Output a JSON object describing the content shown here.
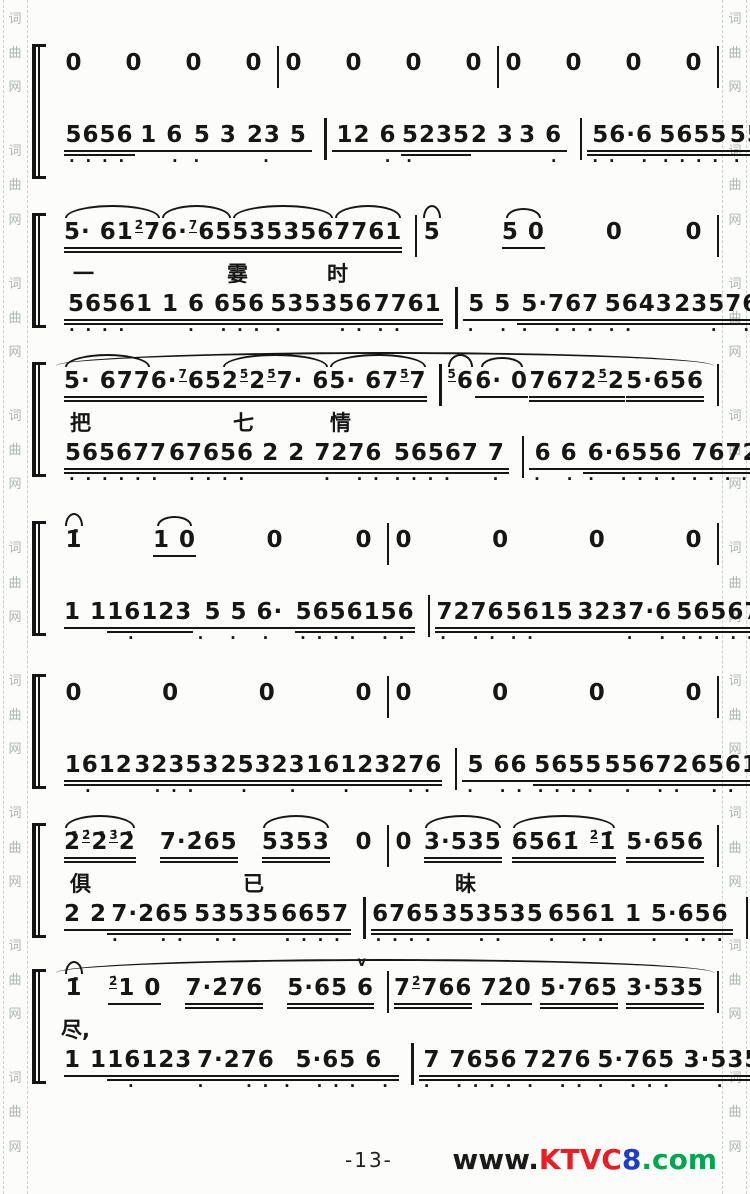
{
  "colors": {
    "ink": "#161616",
    "paper": "#fcfcfa",
    "border_char": "#aeb6ae",
    "watermark_www": "#1a1a1a",
    "watermark_ktvc": "#ec1c24",
    "watermark_eight": "#1f3ccc",
    "watermark_com": "#00a650"
  },
  "border": {
    "chars": [
      "词",
      "曲",
      "网"
    ],
    "repeats": 9
  },
  "footer": {
    "page_number": "-13-",
    "watermark": {
      "www": "www.",
      "ktvc": "KTVC",
      "eight": "8",
      "com": ".com"
    }
  },
  "systems": [
    {
      "melody": [
        [
          {
            "t": "0"
          },
          {
            "t": "0"
          },
          {
            "t": "0"
          },
          {
            "t": "0"
          }
        ],
        [
          {
            "t": "0"
          },
          {
            "t": "0"
          },
          {
            "t": "0"
          },
          {
            "t": "0"
          }
        ],
        [
          {
            "t": "0"
          },
          {
            "t": "0"
          },
          {
            "t": "0"
          },
          {
            "t": "0"
          }
        ]
      ],
      "lyrics": [],
      "accomp": [
        [
          {
            "t": "5656",
            "u": 2,
            "db": "...."
          },
          {
            "t": "1 6",
            "u": 1,
            "db": "  ."
          },
          {
            "t": "5 3",
            "u": 1,
            "db": ".  "
          },
          {
            "t": "23 5",
            "u": 1,
            "db": " .  "
          }
        ],
        [
          {
            "t": "12 6",
            "u": 1,
            "db": "   ."
          },
          {
            "t": "5235",
            "u": 2,
            "db": ".   "
          },
          {
            "t": "2 3",
            "u": 1
          },
          {
            "t": "3 6",
            "u": 1,
            "db": "  ."
          }
        ],
        [
          {
            "t": "56·6",
            "u": 2,
            "db": ".. ."
          },
          {
            "t": "5655",
            "u": 2,
            "db": "...."
          },
          {
            "t": "55672",
            "u": 2,
            "db": ". ...",
            "ann": "(内)"
          },
          {
            "t": "65612",
            "u": 2,
            "db": ".  ..",
            "ann": "(内)"
          }
        ]
      ]
    },
    {
      "melody": [
        [
          {
            "t": "5· 61{2̇}7",
            "u": 2,
            "arc": true
          },
          {
            "t": "6·{7}65",
            "u": 2,
            "arc": true
          },
          {
            "t": "535356",
            "u": 2,
            "arc": true
          },
          {
            "t": "7761",
            "u": 2,
            "arc": true
          }
        ],
        [
          {
            "t": "5",
            "arc": true
          },
          {
            "t": "5 0",
            "u": 1,
            "tie": true
          },
          {
            "t": "0"
          },
          {
            "t": "0"
          }
        ]
      ],
      "lyrics": [
        {
          "x": 15,
          "t": "一"
        },
        {
          "x": 169,
          "t": "霎"
        },
        {
          "x": 269,
          "t": "时"
        }
      ],
      "accomp": [
        [
          {
            "t": "56561 1",
            "u": 2,
            "db": "....   "
          },
          {
            "t": "6 656",
            "u": 2,
            "db": ". ..."
          },
          {
            "t": "535356",
            "u": 2,
            "db": ".   .."
          },
          {
            "t": "7761",
            "u": 2,
            "db": "..  "
          }
        ],
        [
          {
            "t": "5 5",
            "u": 1,
            "db": ". ."
          },
          {
            "t": "5·767",
            "u": 2,
            "db": ". ..."
          },
          {
            "t": "5643",
            "u": 2,
            "db": "..  "
          },
          {
            "t": "23576",
            "u": 2,
            "db": "  . ."
          }
        ]
      ]
    },
    {
      "topline": true,
      "melody": [
        [
          {
            "t": "5· 677",
            "u": 2,
            "arc": true
          },
          {
            "t": "6·{7}65",
            "u": 2
          },
          {
            "t": "2{5̇}2{5̇}7· 6",
            "u": 2,
            "arc": true
          },
          {
            "t": "5· 67{5̇}7",
            "u": 2,
            "arc": true
          }
        ],
        [
          {
            "t": "{5̇}6",
            "arc": true
          },
          {
            "t": "6· 0",
            "u": 1,
            "tie": true
          },
          {
            "t": "7672{5̇}2",
            "u": 2
          },
          {
            "t": "5·656",
            "u": 2
          }
        ]
      ],
      "lyrics": [
        {
          "x": 12,
          "t": "把"
        },
        {
          "x": 175,
          "t": "七"
        },
        {
          "x": 272,
          "t": "情"
        }
      ],
      "accomp": [
        [
          {
            "t": "565677",
            "u": 2,
            "db": "......"
          },
          {
            "t": "67656",
            "u": 2,
            "db": " ...."
          },
          {
            "t": "2 2 7276",
            "u": 2,
            "db": "    . .."
          },
          {
            "t": "56567 7",
            "u": 2,
            "db": "....  ."
          }
        ],
        [
          {
            "t": "6 6",
            "u": 1,
            "db": ". ."
          },
          {
            "t": "6·6556",
            "u": 2,
            "db": ". ...."
          },
          {
            "t": "7672 2",
            "u": 2,
            "db": ".... ."
          },
          {
            "t": "5·656",
            "u": 2,
            "db": ". ..."
          }
        ]
      ]
    },
    {
      "melody": [
        [
          {
            "t": "1̇",
            "arc": true
          },
          {
            "t": "1 0",
            "u": 1,
            "tie": true
          },
          {
            "t": "0"
          },
          {
            "t": "0"
          }
        ],
        [
          {
            "t": "0"
          },
          {
            "t": "0"
          },
          {
            "t": "0"
          },
          {
            "t": "0"
          }
        ]
      ],
      "lyrics": [],
      "accomp": [
        [
          {
            "t": "1 1",
            "u": 1
          },
          {
            "t": "16123",
            "u": 2,
            "db": " .   "
          },
          {
            "t": "5 5 6·",
            "u": 1,
            "db": ". . . "
          },
          {
            "t": "5656156",
            "u": 2,
            "db": ".... .."
          }
        ],
        [
          {
            "t": "7276",
            "u": 2,
            "db": ". .."
          },
          {
            "t": "5615",
            "u": 2,
            "db": ".. "
          },
          {
            "t": "3237·6",
            "u": 2,
            "db": "   . ."
          },
          {
            "t": "56567656",
            "u": 2,
            "db": "........"
          }
        ]
      ]
    },
    {
      "melody": [
        [
          {
            "t": "0"
          },
          {
            "t": "0"
          },
          {
            "t": "0"
          },
          {
            "t": "0"
          }
        ],
        [
          {
            "t": "0"
          },
          {
            "t": "0"
          },
          {
            "t": "0"
          },
          {
            "t": "0"
          }
        ]
      ],
      "lyrics": [],
      "accomp": [
        [
          {
            "t": "1612",
            "u": 2,
            "db": " .  "
          },
          {
            "t": "32353",
            "u": 2,
            "db": " ... "
          },
          {
            "t": "25323",
            "u": 2,
            "db": " .  ."
          },
          {
            "t": "16123276",
            "u": 2,
            "db": "  .   .."
          }
        ],
        [
          {
            "t": "5 66",
            "u": 1,
            "db": ". .."
          },
          {
            "t": "5655",
            "u": 2,
            "db": "...."
          },
          {
            "t": "55672",
            "u": 2,
            "db": " . .."
          },
          {
            "t": "656161",
            "u": 2,
            "db": " .. .."
          }
        ]
      ]
    },
    {
      "melody": [
        [
          {
            "t": "2̇{2̇}2̇{3̇}2̇",
            "u": 2,
            "arc": true
          },
          {
            "t": "7·2̇65",
            "u": 2
          },
          {
            "t": "5353",
            "u": 2,
            "arc": true
          },
          {
            "t": "0"
          }
        ],
        [
          {
            "t": "0"
          },
          {
            "t": "3·535",
            "u": 2,
            "arc": true
          },
          {
            "t": "6561̇ {2̇}1̇",
            "u": 2,
            "arc": true
          },
          {
            "t": "5·656",
            "u": 2
          }
        ]
      ],
      "lyrics": [
        {
          "x": 12,
          "t": "俱"
        },
        {
          "x": 185,
          "t": "已"
        },
        {
          "x": 397,
          "t": "昧"
        }
      ],
      "accomp": [
        [
          {
            "t": "2 2",
            "u": 1
          },
          {
            "t": "7·265",
            "u": 2,
            "db": ".  .."
          },
          {
            "t": "53535",
            "u": 2,
            "db": " ..  "
          },
          {
            "t": "6657",
            "u": 2,
            "db": "...."
          }
        ],
        [
          {
            "t": "6765",
            "u": 2,
            "db": "...."
          },
          {
            "t": "353535",
            "u": 2,
            "db": "  ..  "
          },
          {
            "t": "6561 1",
            "u": 2,
            "db": ". ..  "
          },
          {
            "t": "5·656",
            "u": 2,
            "db": ". ..."
          }
        ]
      ]
    },
    {
      "topline": true,
      "melody": [
        [
          {
            "t": "1̇",
            "arc": true
          },
          {
            "t": "{2̇}1 0",
            "u": 1
          },
          {
            "t": "7·2̇76",
            "u": 2
          },
          {
            "t": "5·65 6",
            "u": 2,
            "mark": "v"
          }
        ],
        [
          {
            "t": "7{2̇}766",
            "u": 2
          },
          {
            "t": "72̇0",
            "u": 1
          },
          {
            "t": "5·765",
            "u": 2
          },
          {
            "t": "3·535",
            "u": 2
          }
        ]
      ],
      "lyrics": [
        {
          "x": 3,
          "t": "尽,"
        }
      ],
      "accomp": [
        [
          {
            "t": "1 1",
            "u": 1
          },
          {
            "t": "16123",
            "u": 2,
            "db": " .   "
          },
          {
            "t": "7·276",
            "u": 2,
            "db": ".  .."
          },
          {
            "t": "5·65 6",
            "u": 2,
            "db": ". ... ."
          }
        ],
        [
          {
            "t": "7 7656",
            "u": 2,
            "db": ". ...."
          },
          {
            "t": "7276",
            "u": 2,
            "db": ". .."
          },
          {
            "t": "5·765",
            "u": 2,
            "db": ". ..."
          },
          {
            "t": "3·5356",
            "u": 2,
            "db": "  . .."
          }
        ]
      ]
    }
  ]
}
